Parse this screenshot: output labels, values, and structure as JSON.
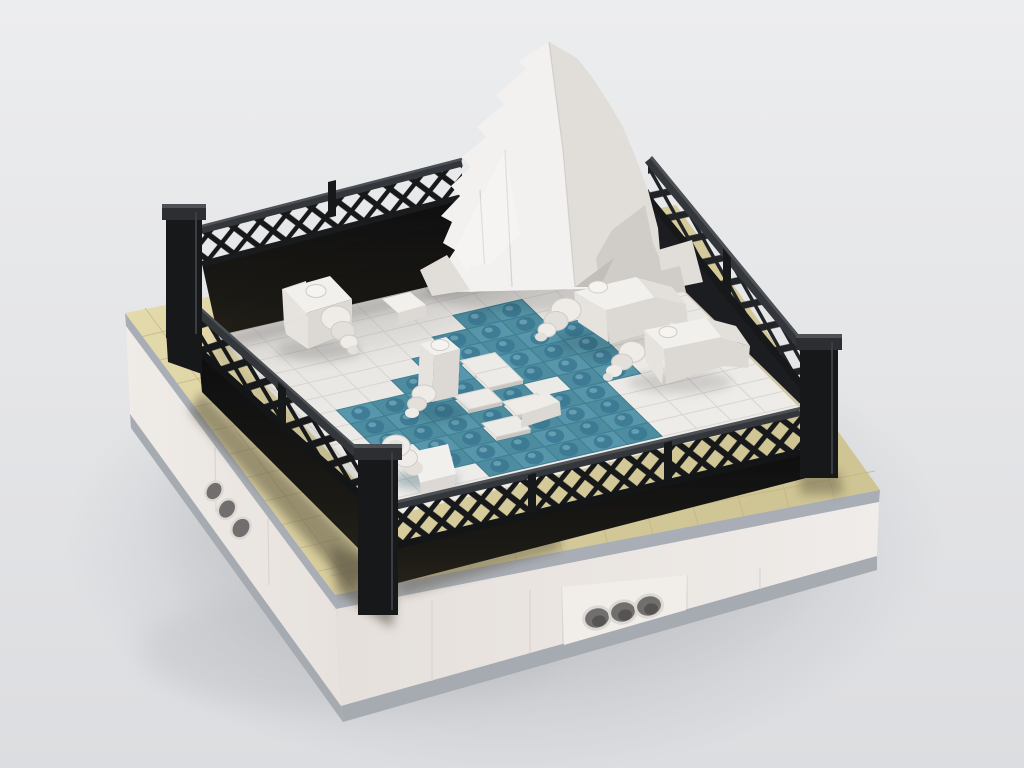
{
  "meta": {
    "description": "3D brick-builder render of a LEGO seal enclosure diorama: black lattice fence on a tan and white modular base, white iceberg, teal water pool with five white seals"
  },
  "colors": {
    "bg-top": "#ecedee",
    "bg-bottom": "#dcdde0",
    "ground-shadow": "#aeb1b6",
    "tan": "#dacf9f",
    "tan-light": "#e6ddaf",
    "tan-seam": "#bdb384",
    "tan-shade": "#5f5944",
    "stripe-gray": "#a9aeb6",
    "base-white": "#efebe7",
    "base-white-2": "#e9e4e0",
    "base-bottom": "#a6abb1",
    "hole-dark": "#716f6d",
    "hole-ring": "#dcd8d4",
    "fence-black": "#17181a",
    "fence-wall-top": "#2c2e31",
    "fence-wall-bottom": "#26221a",
    "rail-gray": "#4d5156",
    "rail-mid": "#33373b",
    "floor-white": "#eae8e5",
    "floor-seam": "#d5d2cd",
    "water": "#5897ab",
    "water-alt": "#4e8ca0",
    "water-seam": "#3f7e93",
    "water-stud": "#3a7690",
    "water-stud-hi": "#8fc0cd",
    "island-white": "#edebe7",
    "island-edge": "#c9c5c0",
    "ice-bright": "#f2f1ef",
    "ice-mid": "#e1deda",
    "ice-shade": "#d0cdc8",
    "ice-dark": "#c2bfba",
    "seal-top": "#f2f0ed",
    "seal-side": "#e6e3de",
    "seal-dark": "#dcd8d3",
    "disc-light": "#efece8",
    "disc-mid": "#e3e0db",
    "disc-edge": "#cfccc7"
  },
  "scene": {
    "floor": {
      "origin": [
        218,
        336
      ],
      "vecA": [
        14.0,
        13.7
      ],
      "vecB": [
        34.5,
        -8.0
      ],
      "n": 12,
      "water_tiles": [
        [
          2,
          6
        ],
        [
          2,
          7
        ],
        [
          3,
          5
        ],
        [
          3,
          6
        ],
        [
          3,
          7
        ],
        [
          4,
          4
        ],
        [
          4,
          5
        ],
        [
          4,
          6
        ],
        [
          4,
          7
        ],
        [
          4,
          8
        ],
        [
          5,
          3
        ],
        [
          5,
          4
        ],
        [
          5,
          6
        ],
        [
          5,
          7
        ],
        [
          5,
          8
        ],
        [
          6,
          1
        ],
        [
          6,
          2
        ],
        [
          6,
          3
        ],
        [
          6,
          4
        ],
        [
          6,
          6
        ],
        [
          6,
          7
        ],
        [
          6,
          8
        ],
        [
          7,
          1
        ],
        [
          7,
          2
        ],
        [
          7,
          3
        ],
        [
          7,
          5
        ],
        [
          7,
          7
        ],
        [
          7,
          8
        ],
        [
          8,
          1
        ],
        [
          8,
          2
        ],
        [
          8,
          3
        ],
        [
          8,
          4
        ],
        [
          8,
          6
        ],
        [
          8,
          7
        ],
        [
          9,
          2
        ],
        [
          9,
          3
        ],
        [
          9,
          5
        ],
        [
          9,
          6
        ],
        [
          9,
          7
        ],
        [
          10,
          2
        ],
        [
          10,
          3
        ],
        [
          10,
          4
        ],
        [
          10,
          5
        ],
        [
          10,
          6
        ],
        [
          10,
          7
        ],
        [
          11,
          3
        ],
        [
          11,
          4
        ],
        [
          11,
          5
        ],
        [
          11,
          6
        ],
        [
          11,
          7
        ]
      ],
      "island_tiles": [
        [
          5,
          5
        ],
        [
          6,
          5
        ],
        [
          7,
          4
        ],
        [
          8,
          5
        ],
        [
          9,
          4
        ]
      ]
    },
    "objects": {
      "iceberg": 1,
      "seals": 5,
      "white_slopes": 3,
      "fence_sides": 4,
      "corner_posts": 3,
      "technic_hole_bricks": 2
    }
  }
}
